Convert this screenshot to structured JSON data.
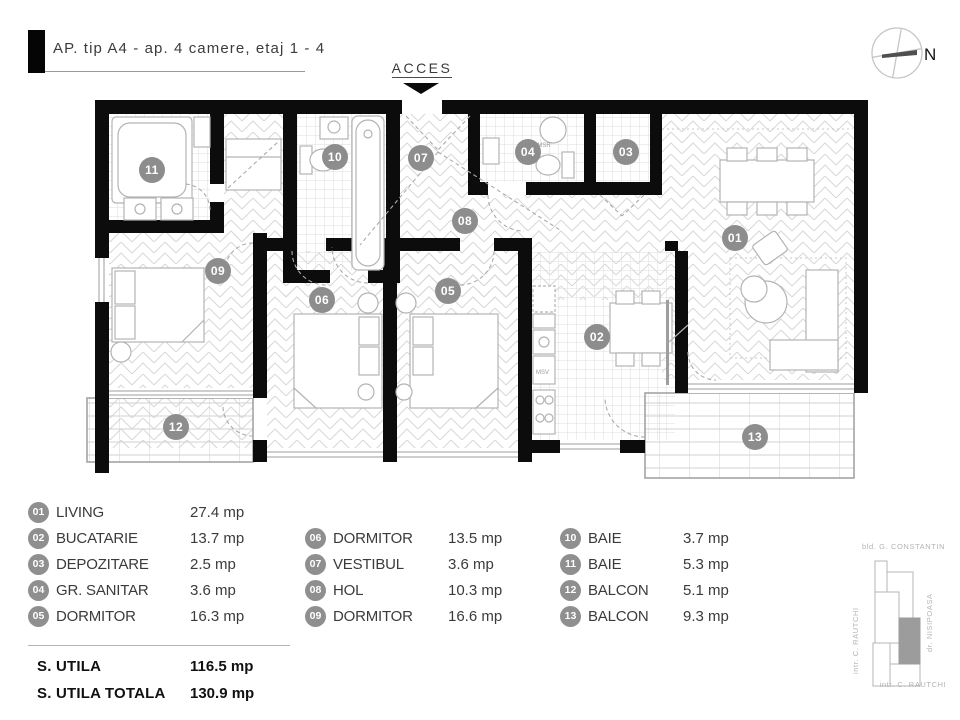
{
  "header": {
    "title": "AP. tip A4 - ap. 4 camere, etaj 1 - 4"
  },
  "plan": {
    "access_label": "ACCES",
    "compass_label": "N",
    "appliance_labels": {
      "msr": "MSR",
      "msv": "MSV"
    }
  },
  "rooms": [
    {
      "number": "01",
      "name": "LIVING",
      "area": "27.4 mp"
    },
    {
      "number": "02",
      "name": "BUCATARIE",
      "area": "13.7 mp"
    },
    {
      "number": "03",
      "name": "DEPOZITARE",
      "area": "2.5 mp"
    },
    {
      "number": "04",
      "name": "GR. SANITAR",
      "area": "3.6 mp"
    },
    {
      "number": "05",
      "name": "DORMITOR",
      "area": "16.3 mp"
    },
    {
      "number": "06",
      "name": "DORMITOR",
      "area": "13.5 mp"
    },
    {
      "number": "07",
      "name": "VESTIBUL",
      "area": "3.6 mp"
    },
    {
      "number": "08",
      "name": "HOL",
      "area": "10.3 mp"
    },
    {
      "number": "09",
      "name": "DORMITOR",
      "area": "16.6 mp"
    },
    {
      "number": "10",
      "name": "BAIE",
      "area": "3.7 mp"
    },
    {
      "number": "11",
      "name": "BAIE",
      "area": "5.3 mp"
    },
    {
      "number": "12",
      "name": "BALCON",
      "area": "5.1 mp"
    },
    {
      "number": "13",
      "name": "BALCON",
      "area": "9.3 mp"
    }
  ],
  "totals": [
    {
      "label": "S. UTILA",
      "value": "116.5 mp"
    },
    {
      "label": "S. UTILA TOTALA",
      "value": "130.9 mp"
    }
  ],
  "minimap": {
    "street_top": "bld. G. CONSTANTIN",
    "street_right": "dr. NISIPOASA",
    "street_left": "intr. C. RAUTCHI",
    "street_bottom": "intr. C. RAUTCHI"
  },
  "colors": {
    "badge": "#8d8d8d",
    "wall": "#0c0c0c",
    "hatch": "#d7d7d7",
    "highlight_unit": "#9c9c9c"
  }
}
